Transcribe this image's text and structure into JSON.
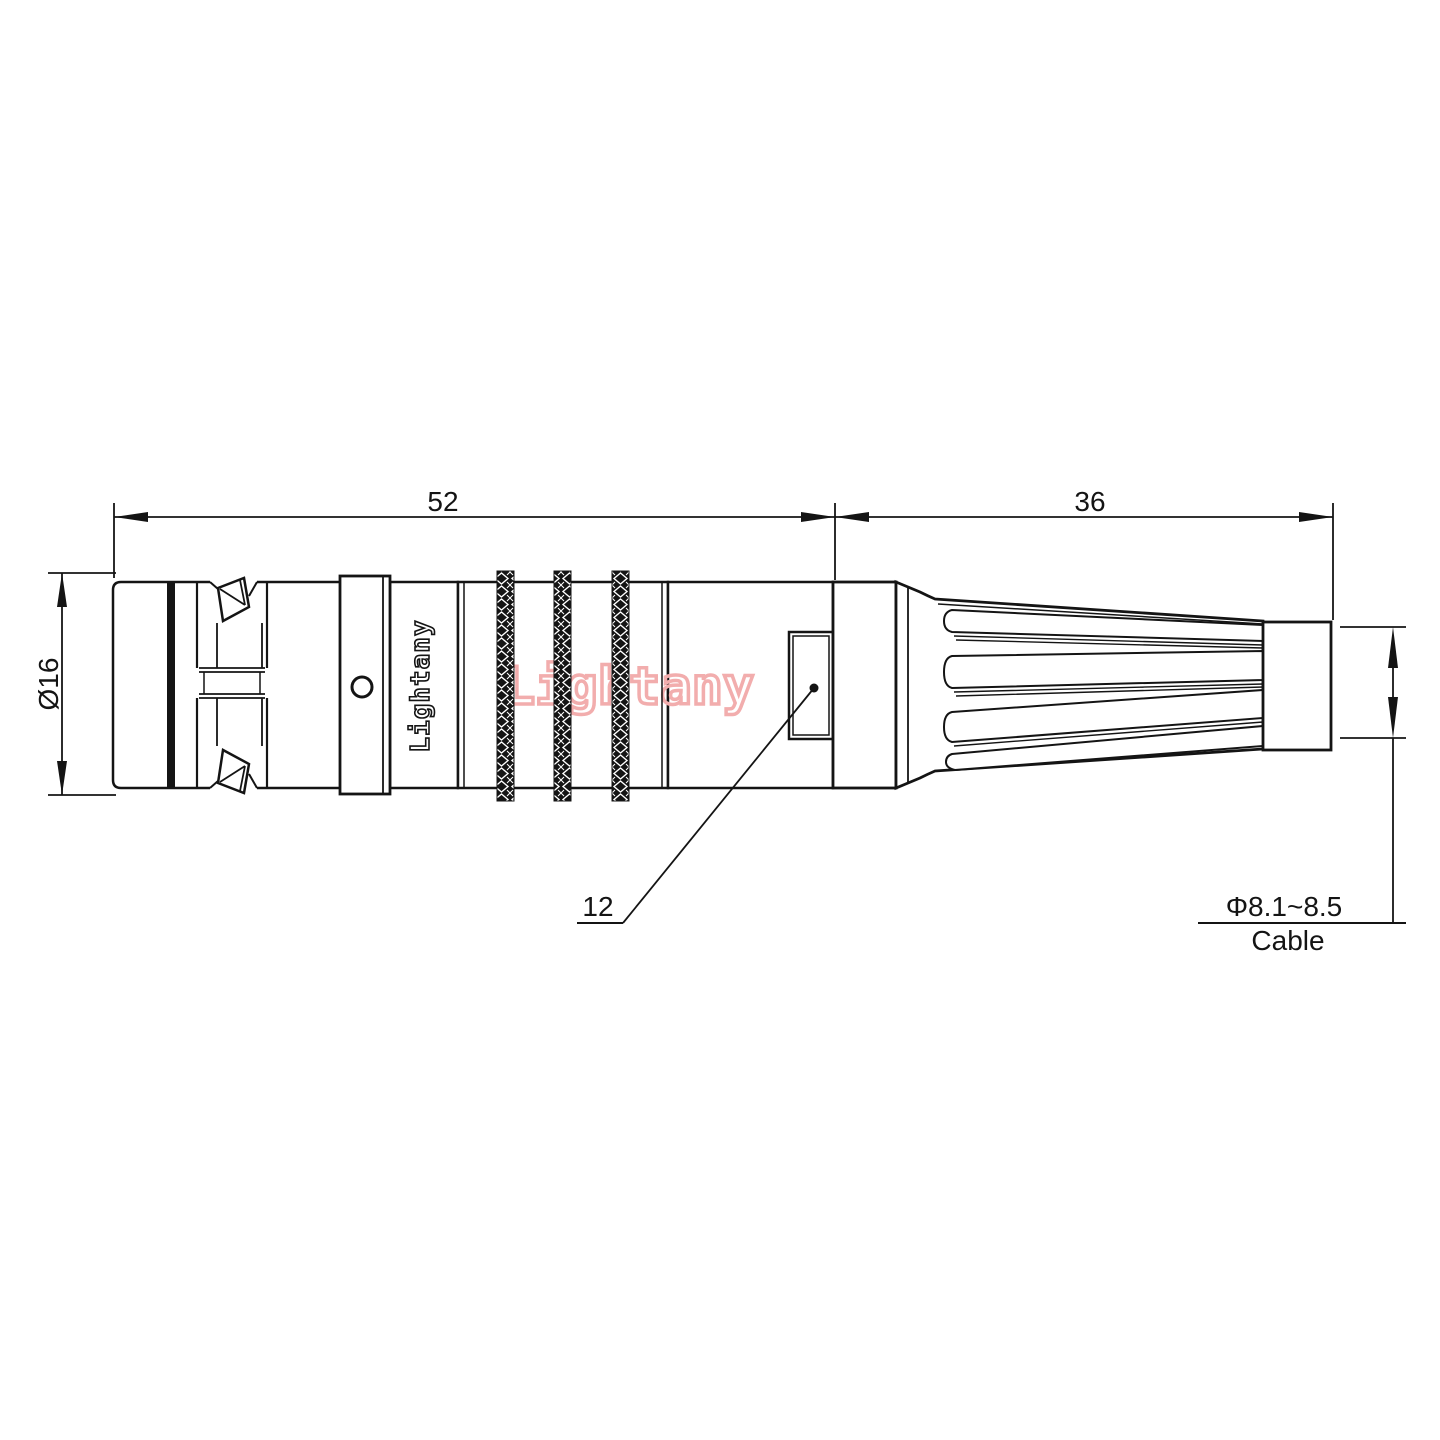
{
  "drawing": {
    "labels": {
      "length_front": "52",
      "length_rear": "36",
      "outer_diameter": "Ø16",
      "shell_size": "12",
      "cable_diameter": "Φ8.1~8.5",
      "cable_caption": "Cable"
    },
    "branding": {
      "body_marking": "Lightany",
      "watermark": "Lightany"
    },
    "colors": {
      "line": "#141414",
      "background": "#ffffff",
      "watermark": "#f2adad"
    }
  }
}
